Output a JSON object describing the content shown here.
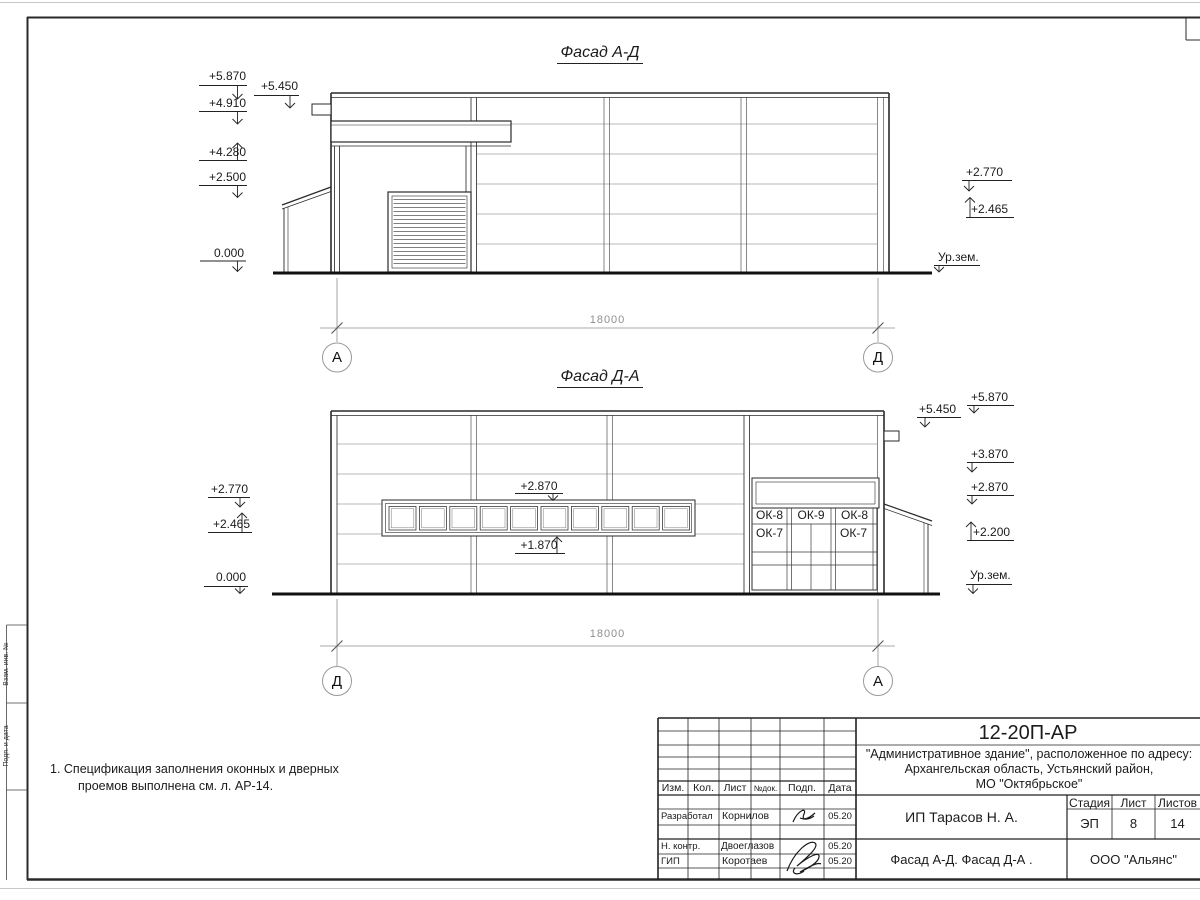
{
  "frame": {
    "strip1": "Взам. инв. №",
    "strip2": "Подп. и дата",
    "strip3": "Инв. № подл."
  },
  "facade_top": {
    "title": "Фасад А-Д",
    "dim": "18000",
    "axis_left": "А",
    "axis_right": "Д",
    "m5870": "+5.870",
    "m5450": "+5.450",
    "m4910": "+4.910",
    "m4280": "+4.280",
    "m2500": "+2.500",
    "m0000": "0.000",
    "m2770": "+2.770",
    "m2465": "+2.465",
    "ground": "Ур.зем."
  },
  "facade_bottom": {
    "title": "Фасад Д-А",
    "dim": "18000",
    "axis_left": "Д",
    "axis_right": "А",
    "m2770": "+2.770",
    "m2465": "+2.465",
    "m0000": "0.000",
    "m2870_ribbon": "+2.870",
    "m1870": "+1.870",
    "m5870": "+5.870",
    "m5450": "+5.450",
    "m3870": "+3.870",
    "m2870": "+2.870",
    "m2200": "+2.200",
    "ground": "Ур.зем.",
    "ok8a": "ОК-8",
    "ok9": "ОК-9",
    "ok8b": "ОК-8",
    "ok7a": "ОК-7",
    "ok7b": "ОК-7"
  },
  "note": {
    "line1": "1. Спецификация заполнения оконных и дверных",
    "line2": "проемов выполнена см. л. АР-14."
  },
  "title_block": {
    "doc_number": "12-20П-АР",
    "project1": "\"Административное здание\", расположенное по адресу:",
    "project2": "Архангельская область, Устьянский район,",
    "project3": "МО \"Октябрьское\"",
    "h_izm": "Изм.",
    "h_kol": "Кол.",
    "h_list": "Лист",
    "h_ndok": "№док.",
    "h_podp": "Подп.",
    "h_data": "Дата",
    "r1_role": "Разработал",
    "r1_name": "Корнилов",
    "r1_date": "05.20",
    "r2_role": "Н. контр.",
    "r2_name": "Двоеглазов",
    "r2_date": "05.20",
    "r3_role": "ГИП",
    "r3_name": "Коротаев",
    "r3_date": "05.20",
    "client": "ИП Тарасов Н. А.",
    "stage_h": "Стадия",
    "sheet_h": "Лист",
    "sheets_h": "Листов",
    "stage": "ЭП",
    "sheet": "8",
    "sheets": "14",
    "sheet_title": "Фасад А-Д. Фасад Д-А .",
    "company": "ООО \"Альянс\""
  }
}
